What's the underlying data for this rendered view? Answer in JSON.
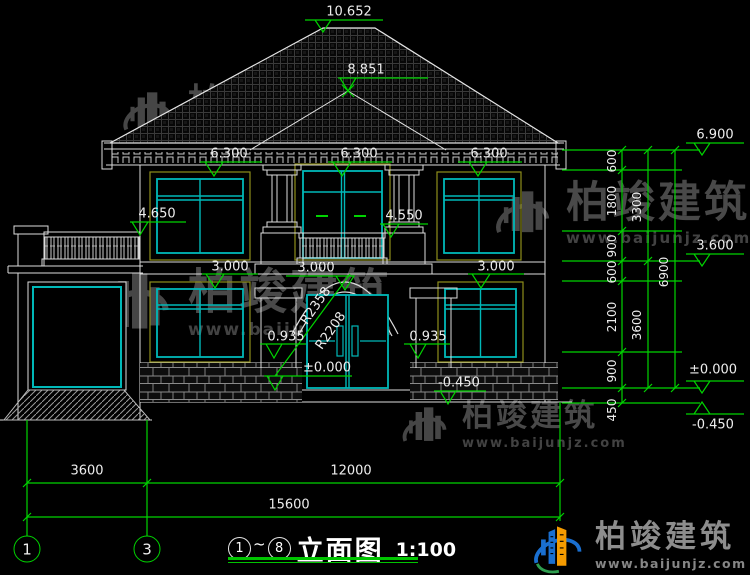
{
  "drawing": {
    "title": {
      "bubble_start": "1",
      "tilde": "~",
      "bubble_end": "8",
      "name": "立面图",
      "scale": "1:100"
    },
    "grid_bubbles": {
      "left": "1",
      "mid": "3"
    },
    "elevation_labels": {
      "ridge": "10.652",
      "porch_ridge": "8.851",
      "eave_right": "6.900",
      "head2_left": "6.300",
      "head2_center": "6.300",
      "head2_right": "6.300",
      "terrace": "4.650",
      "balcony": "4.550",
      "head1_left": "3.000",
      "head1_center": "3.000",
      "head1_right": "3.000",
      "sill_left": "0.935",
      "sill_right": "0.935",
      "floor_zero": "±0.000",
      "ground_center": "-0.450",
      "right_3600": "3.600",
      "right_zero": "±0.000",
      "right_neg": "-0.450"
    },
    "dim_right": {
      "s1": "600",
      "s2": "1800",
      "s3": "900",
      "s4": "600",
      "s5": "2100",
      "s6": "900",
      "s7": "450",
      "sum_upper": "3300",
      "sum_lower": "3600",
      "total": "6900"
    },
    "dim_bottom": {
      "left": "3600",
      "right": "12000",
      "total": "15600"
    },
    "arch": {
      "outer": "R2358",
      "inner": "R2208"
    }
  },
  "watermark": {
    "name": "柏竣建筑",
    "url": "www.baijunjz.com"
  },
  "footer_logo": {
    "name": "柏竣建筑",
    "url": "www.baijunjz.com"
  },
  "colors": {
    "background": "#000000",
    "dimension_green": "#00d400",
    "outline_white": "#e6e6e6",
    "window_teal": "#00b8b8",
    "surround_olive": "#8e8e1a",
    "watermark_gray": "#4e4e4e",
    "logo_blue": "#1a6fd0",
    "logo_orange": "#f59b00"
  }
}
